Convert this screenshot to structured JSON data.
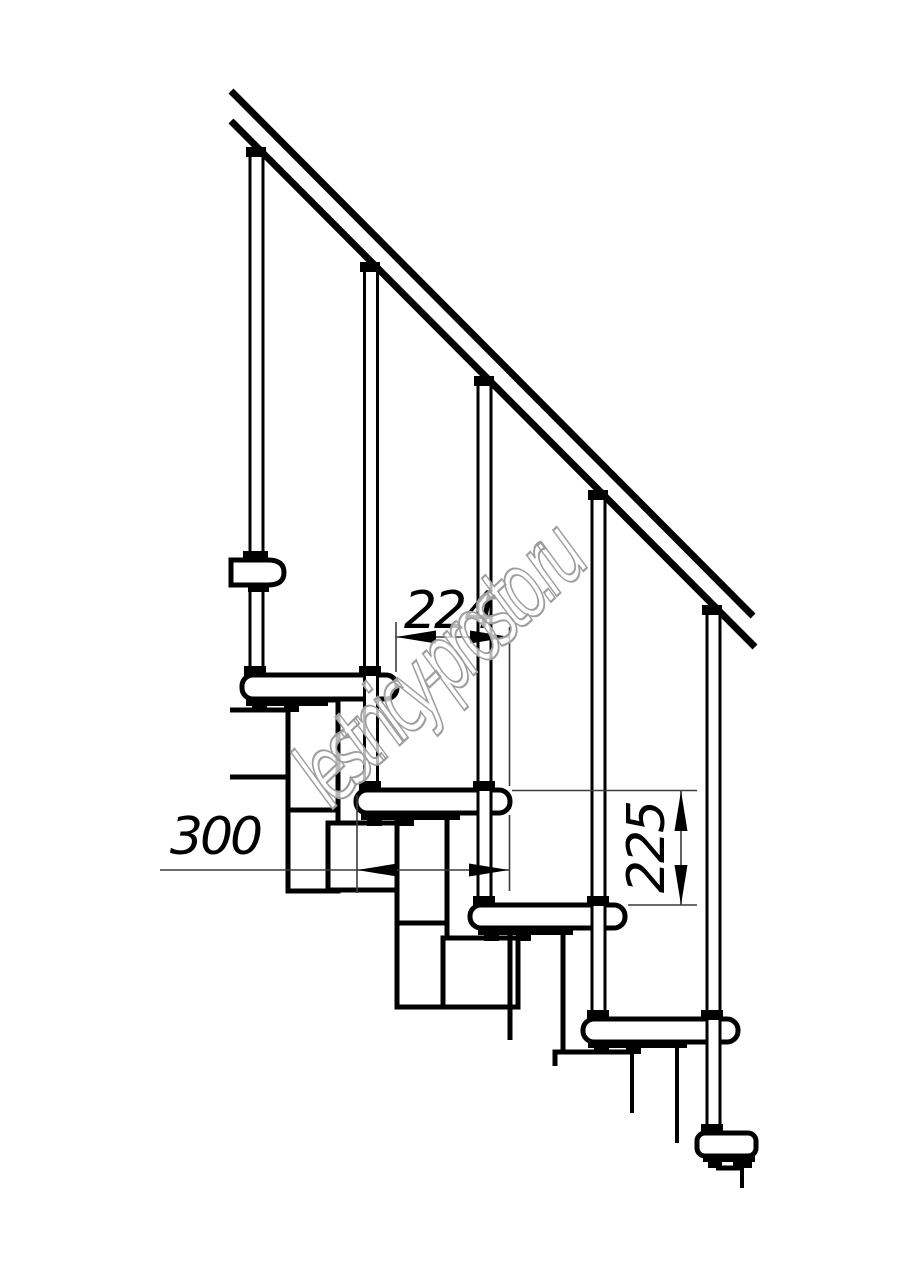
{
  "page": {
    "background": "#ffffff",
    "description": "Side-view technical drawing of a modular staircase with handrail, balusters, treads and support modules"
  },
  "drawing": {
    "line_color": "#000000",
    "thin_line_color": "#3c3c3c",
    "dimensions": {
      "step_run": {
        "value": "224",
        "orientation": "horizontal"
      },
      "tread_depth": {
        "value": "300",
        "orientation": "horizontal"
      },
      "riser_height": {
        "value": "225",
        "orientation": "vertical"
      }
    },
    "watermark": {
      "text": "lestnicy-prosto.ru",
      "color": "#9e9e9e"
    }
  }
}
